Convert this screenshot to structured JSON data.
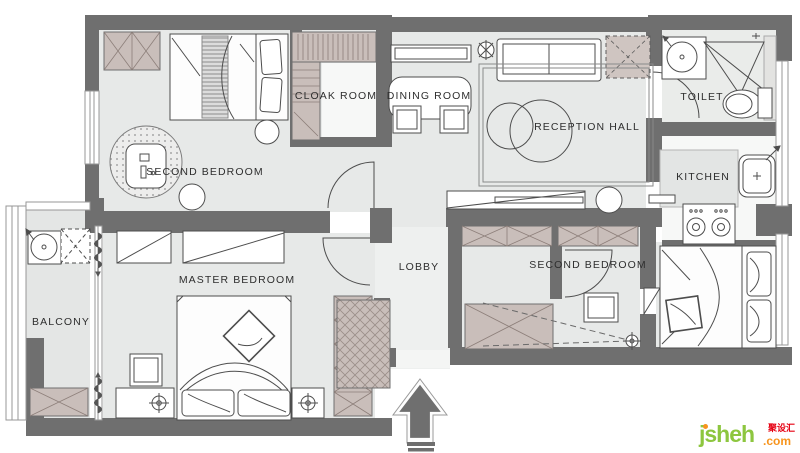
{
  "title": "apartment floor plan",
  "rooms": [
    {
      "id": "second-bedroom-top",
      "label": "SECOND BEDROOM"
    },
    {
      "id": "cloak-room",
      "label": "CLOAK ROOM"
    },
    {
      "id": "dining-room",
      "label": "DINING ROOM"
    },
    {
      "id": "reception-hall",
      "label": "RECEPTION HALL"
    },
    {
      "id": "toilet",
      "label": "TOILET"
    },
    {
      "id": "kitchen",
      "label": "KITCHEN"
    },
    {
      "id": "master-bedroom",
      "label": "MASTER BEDROOM"
    },
    {
      "id": "balcony",
      "label": "BALCONY"
    },
    {
      "id": "lobby",
      "label": "LOBBY"
    },
    {
      "id": "second-bedroom-bottom",
      "label": "SECOND BEDROOM"
    }
  ],
  "logo": {
    "main": "jsheh",
    "tld": ".com",
    "cjk": "聚设汇"
  },
  "colors": {
    "wall": "#6f6f6f",
    "floor": "#e7e9e8",
    "hatch_fill": "#c9beba",
    "hatch_line": "#8d7f7a",
    "line": "#4d4d4d",
    "logo_green": "#8dc63f",
    "logo_orange": "#f7941d",
    "logo_red": "#e60012"
  }
}
